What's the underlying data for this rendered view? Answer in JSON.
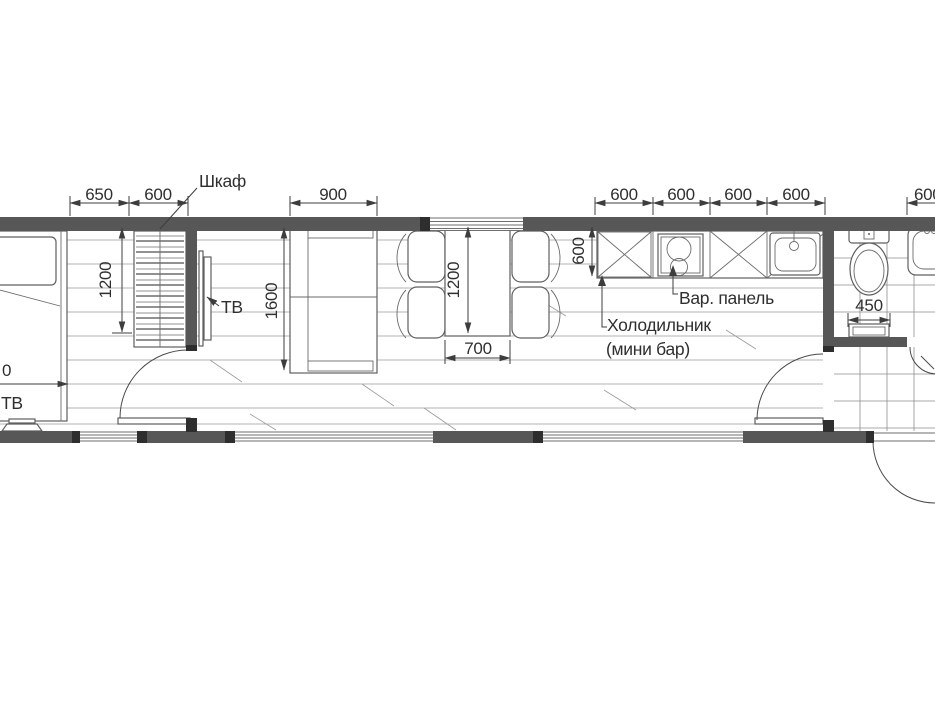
{
  "drawing": {
    "kind": "floor-plan",
    "language": "ru",
    "dims": {
      "d650": "650",
      "d600_left": "600",
      "d900": "900",
      "k600": [
        "600",
        "600",
        "600",
        "600"
      ],
      "d600_right": "600",
      "v1200_left": "1200",
      "v1600_sofa": "1600",
      "v1200_table": "1200",
      "h700_table": "700",
      "v600_fridge": "600",
      "d450_wc": "450",
      "cut_left": "0"
    },
    "labels": {
      "wardrobe": "Шкаф",
      "tv_wall": "ТВ",
      "tv_bed": "ТВ",
      "cooktop": "Вар. панель",
      "fridge_line1": "Холодильник",
      "fridge_line2": "(мини бар)"
    }
  }
}
